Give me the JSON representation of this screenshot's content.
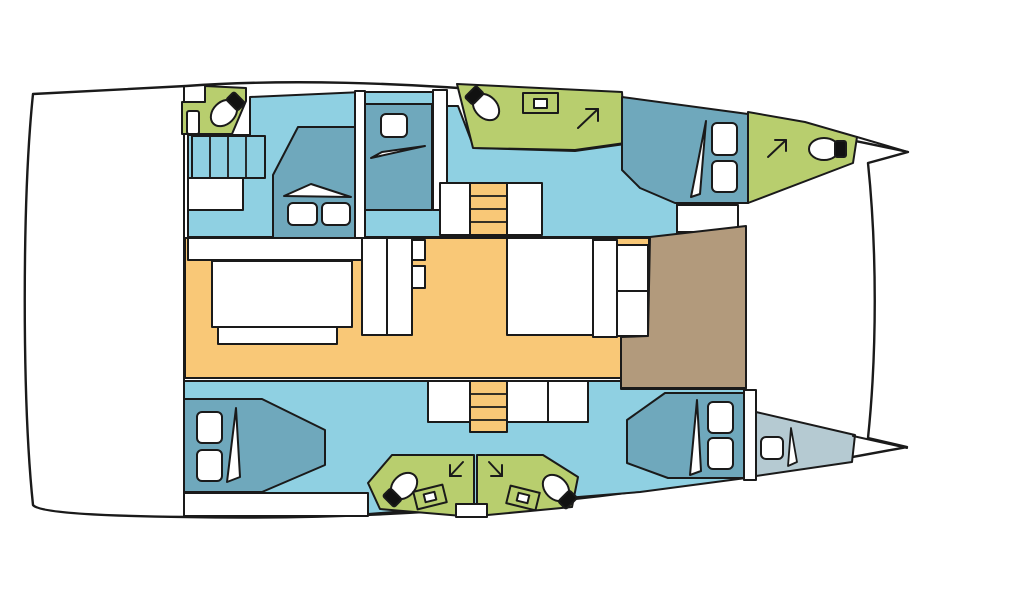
{
  "colors": {
    "hull": "#ffffff",
    "outline": "#1a1a1a",
    "cabin_floor": "#8fd0e2",
    "bed": "#6fa8bc",
    "bathroom": "#b8ce6e",
    "saloon": "#f9c877",
    "deck_brown": "#b29a7c",
    "crew": "#b5cad2",
    "white": "#ffffff",
    "black": "#111111"
  },
  "icons": {
    "toilet": "oval-bowl-with-black-tank",
    "sink": "rectangle-with-inner-basin",
    "direction_arrow": "diagonal-corner-arrow",
    "stairs": "banded-steps",
    "bed": "platform-with-pillows-and-blanket-fold"
  }
}
